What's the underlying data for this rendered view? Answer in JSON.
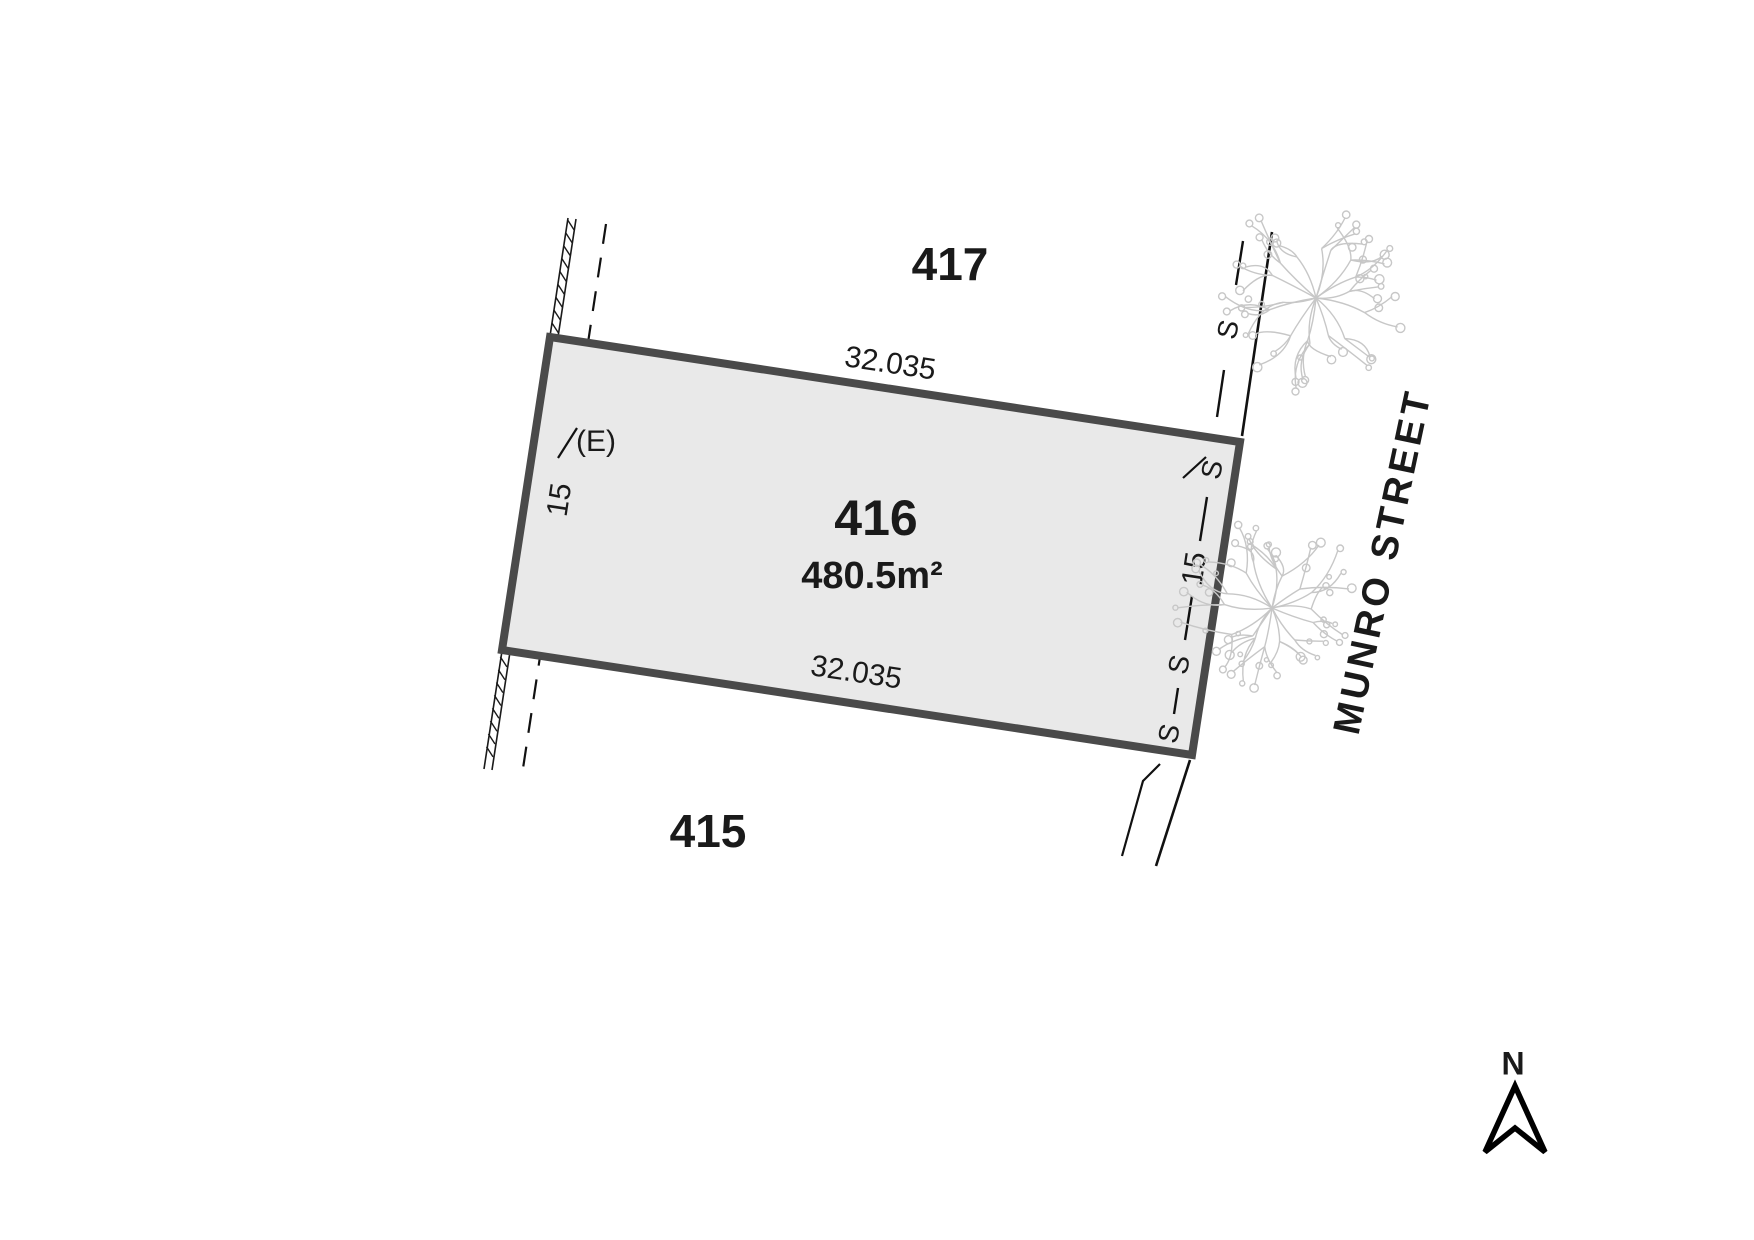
{
  "plan": {
    "lots": {
      "main_number": "416",
      "main_area": "480.5m²",
      "north_neighbour": "417",
      "south_neighbour": "415"
    },
    "street": {
      "name": "MUNRO STREET"
    },
    "dimensions": {
      "top": "32.035",
      "bottom": "32.035",
      "left": "15",
      "right": "15"
    },
    "easement": {
      "label": "(E)"
    },
    "sewer": {
      "mark": "S"
    },
    "compass": {
      "north": "N"
    },
    "colors": {
      "lot_fill": "#e9e9e9",
      "lot_stroke": "#4a4a4a",
      "line": "#1a1a1a",
      "tree": "#c7c7c7"
    }
  }
}
